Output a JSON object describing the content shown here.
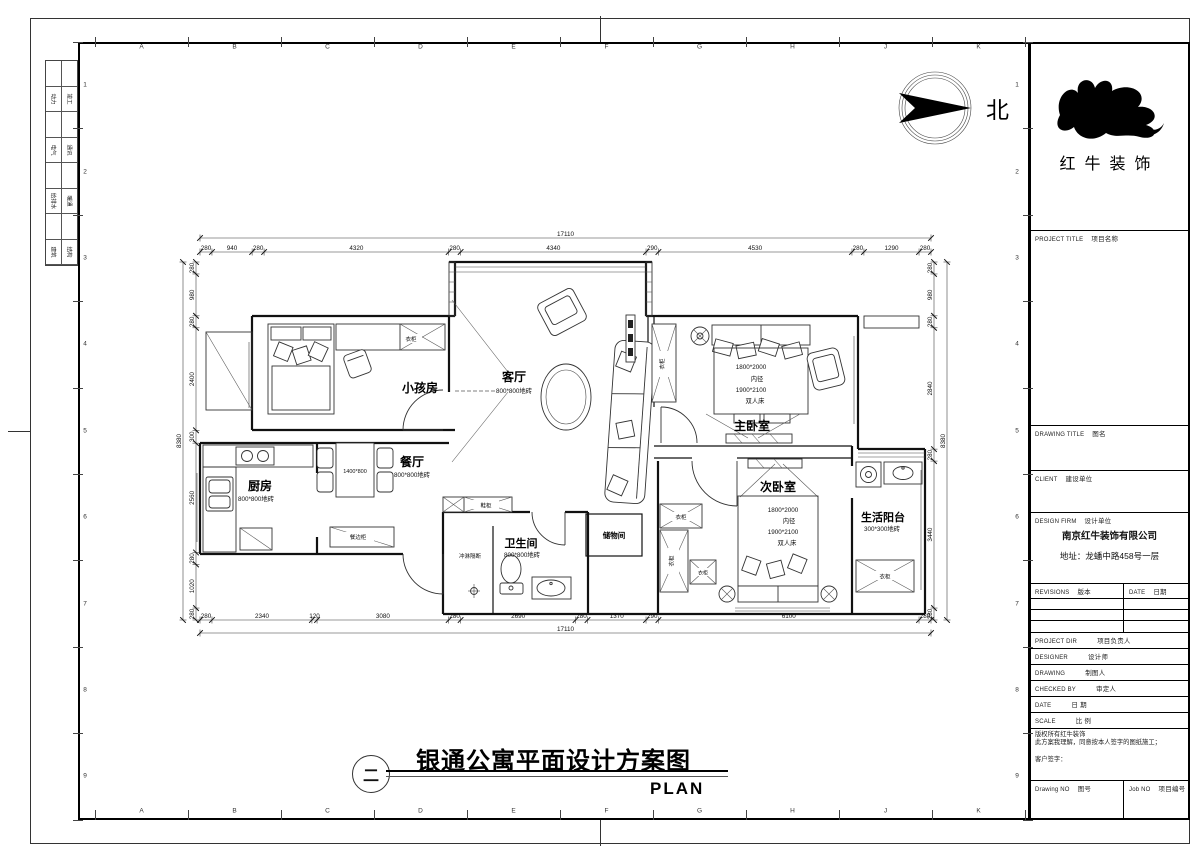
{
  "drawing": {
    "number_circle": "二",
    "title": "银通公寓平面设计方案图",
    "subtitle": "PLAN",
    "north": "北"
  },
  "grid": {
    "columns": [
      "A",
      "B",
      "C",
      "D",
      "E",
      "F",
      "G",
      "H",
      "J",
      "K"
    ],
    "rows": [
      "1",
      "2",
      "3",
      "4",
      "5",
      "6",
      "7",
      "8",
      "9"
    ]
  },
  "stamp_boxes": [
    [
      "动力",
      "竣工"
    ],
    [
      "电气",
      "通讯"
    ],
    [
      "给排水",
      "暖通"
    ],
    [
      "建筑",
      "结构"
    ]
  ],
  "plan": {
    "rooms": {
      "kids": {
        "name": "小孩房"
      },
      "living": {
        "name": "客厅",
        "floor": "800*800地砖"
      },
      "dining": {
        "name": "餐厅",
        "floor": "800*800地砖"
      },
      "kitchen": {
        "name": "厨房",
        "floor": "800*800地砖"
      },
      "bath": {
        "name": "卫生间",
        "floor": "800*800地砖"
      },
      "master": {
        "name": "主卧室"
      },
      "second": {
        "name": "次卧室"
      },
      "balcony": {
        "name": "生活阳台",
        "floor": "300*300地砖"
      },
      "storage": {
        "name": "储物间"
      }
    },
    "labels": {
      "wardrobe": "衣柜",
      "shoe_cabinet": "鞋柜",
      "sideboard": "餐边柜",
      "shower_screen": "冲淋隔断",
      "table_size": "1400*800"
    },
    "bed_spec": [
      "1800*2000",
      "内径",
      "1900*2100",
      "双人床"
    ],
    "dimensions": {
      "top": {
        "segments": [
          "280",
          "940",
          "280",
          "4320",
          "280",
          "4340",
          "290",
          "4530",
          "280",
          "1290",
          "280"
        ],
        "total": "17110"
      },
      "bottom": {
        "segments": [
          "280",
          "2340",
          "120",
          "3080",
          "280",
          "2690",
          "280",
          "1370",
          "290",
          "6100",
          "280"
        ],
        "total": "17110"
      },
      "left": {
        "segments": [
          "280",
          "980",
          "280",
          "2400",
          "300",
          "2560",
          "280",
          "1020",
          "280"
        ],
        "total": "8380"
      },
      "right": {
        "segments": [
          "280",
          "980",
          "280",
          "2840",
          "280",
          "3440",
          "280"
        ],
        "total": "8380"
      }
    }
  },
  "titleblock": {
    "brand": "红牛装饰",
    "project_title": {
      "en": "PROJECT TITLE",
      "zh": "项目名称"
    },
    "drawing_title": {
      "en": "DRAWING TITLE",
      "zh": "图名"
    },
    "client": {
      "en": "CLIENT",
      "zh": "建设单位"
    },
    "design_firm": {
      "en": "DESIGN FIRM",
      "zh": "设计单位"
    },
    "firm_name": "南京红牛装饰有限公司",
    "firm_address": "地址：龙蟠中路458号一层",
    "revisions": {
      "en": "REVISIONS",
      "zh": "版本"
    },
    "date_col": {
      "en": "DATE",
      "zh": "日期"
    },
    "rows": [
      {
        "en": "PROJECT DIR",
        "zh": "项目负责人"
      },
      {
        "en": "DESIGNER",
        "zh": "设计师"
      },
      {
        "en": "DRAWING",
        "zh": "制图人"
      },
      {
        "en": "CHECKED BY",
        "zh": "审定人"
      },
      {
        "en": "DATE",
        "zh": "日  期"
      },
      {
        "en": "SCALE",
        "zh": "比  例"
      }
    ],
    "copyright_note": "版权所有红牛装饰",
    "note": "此方案我理解，同意按本人签字的图纸施工；",
    "client_sign": "客户签字：",
    "drawing_no": {
      "en": "Drawing NO",
      "zh": "图号"
    },
    "job_no": {
      "en": "Job NO",
      "zh": "项目编号"
    }
  }
}
